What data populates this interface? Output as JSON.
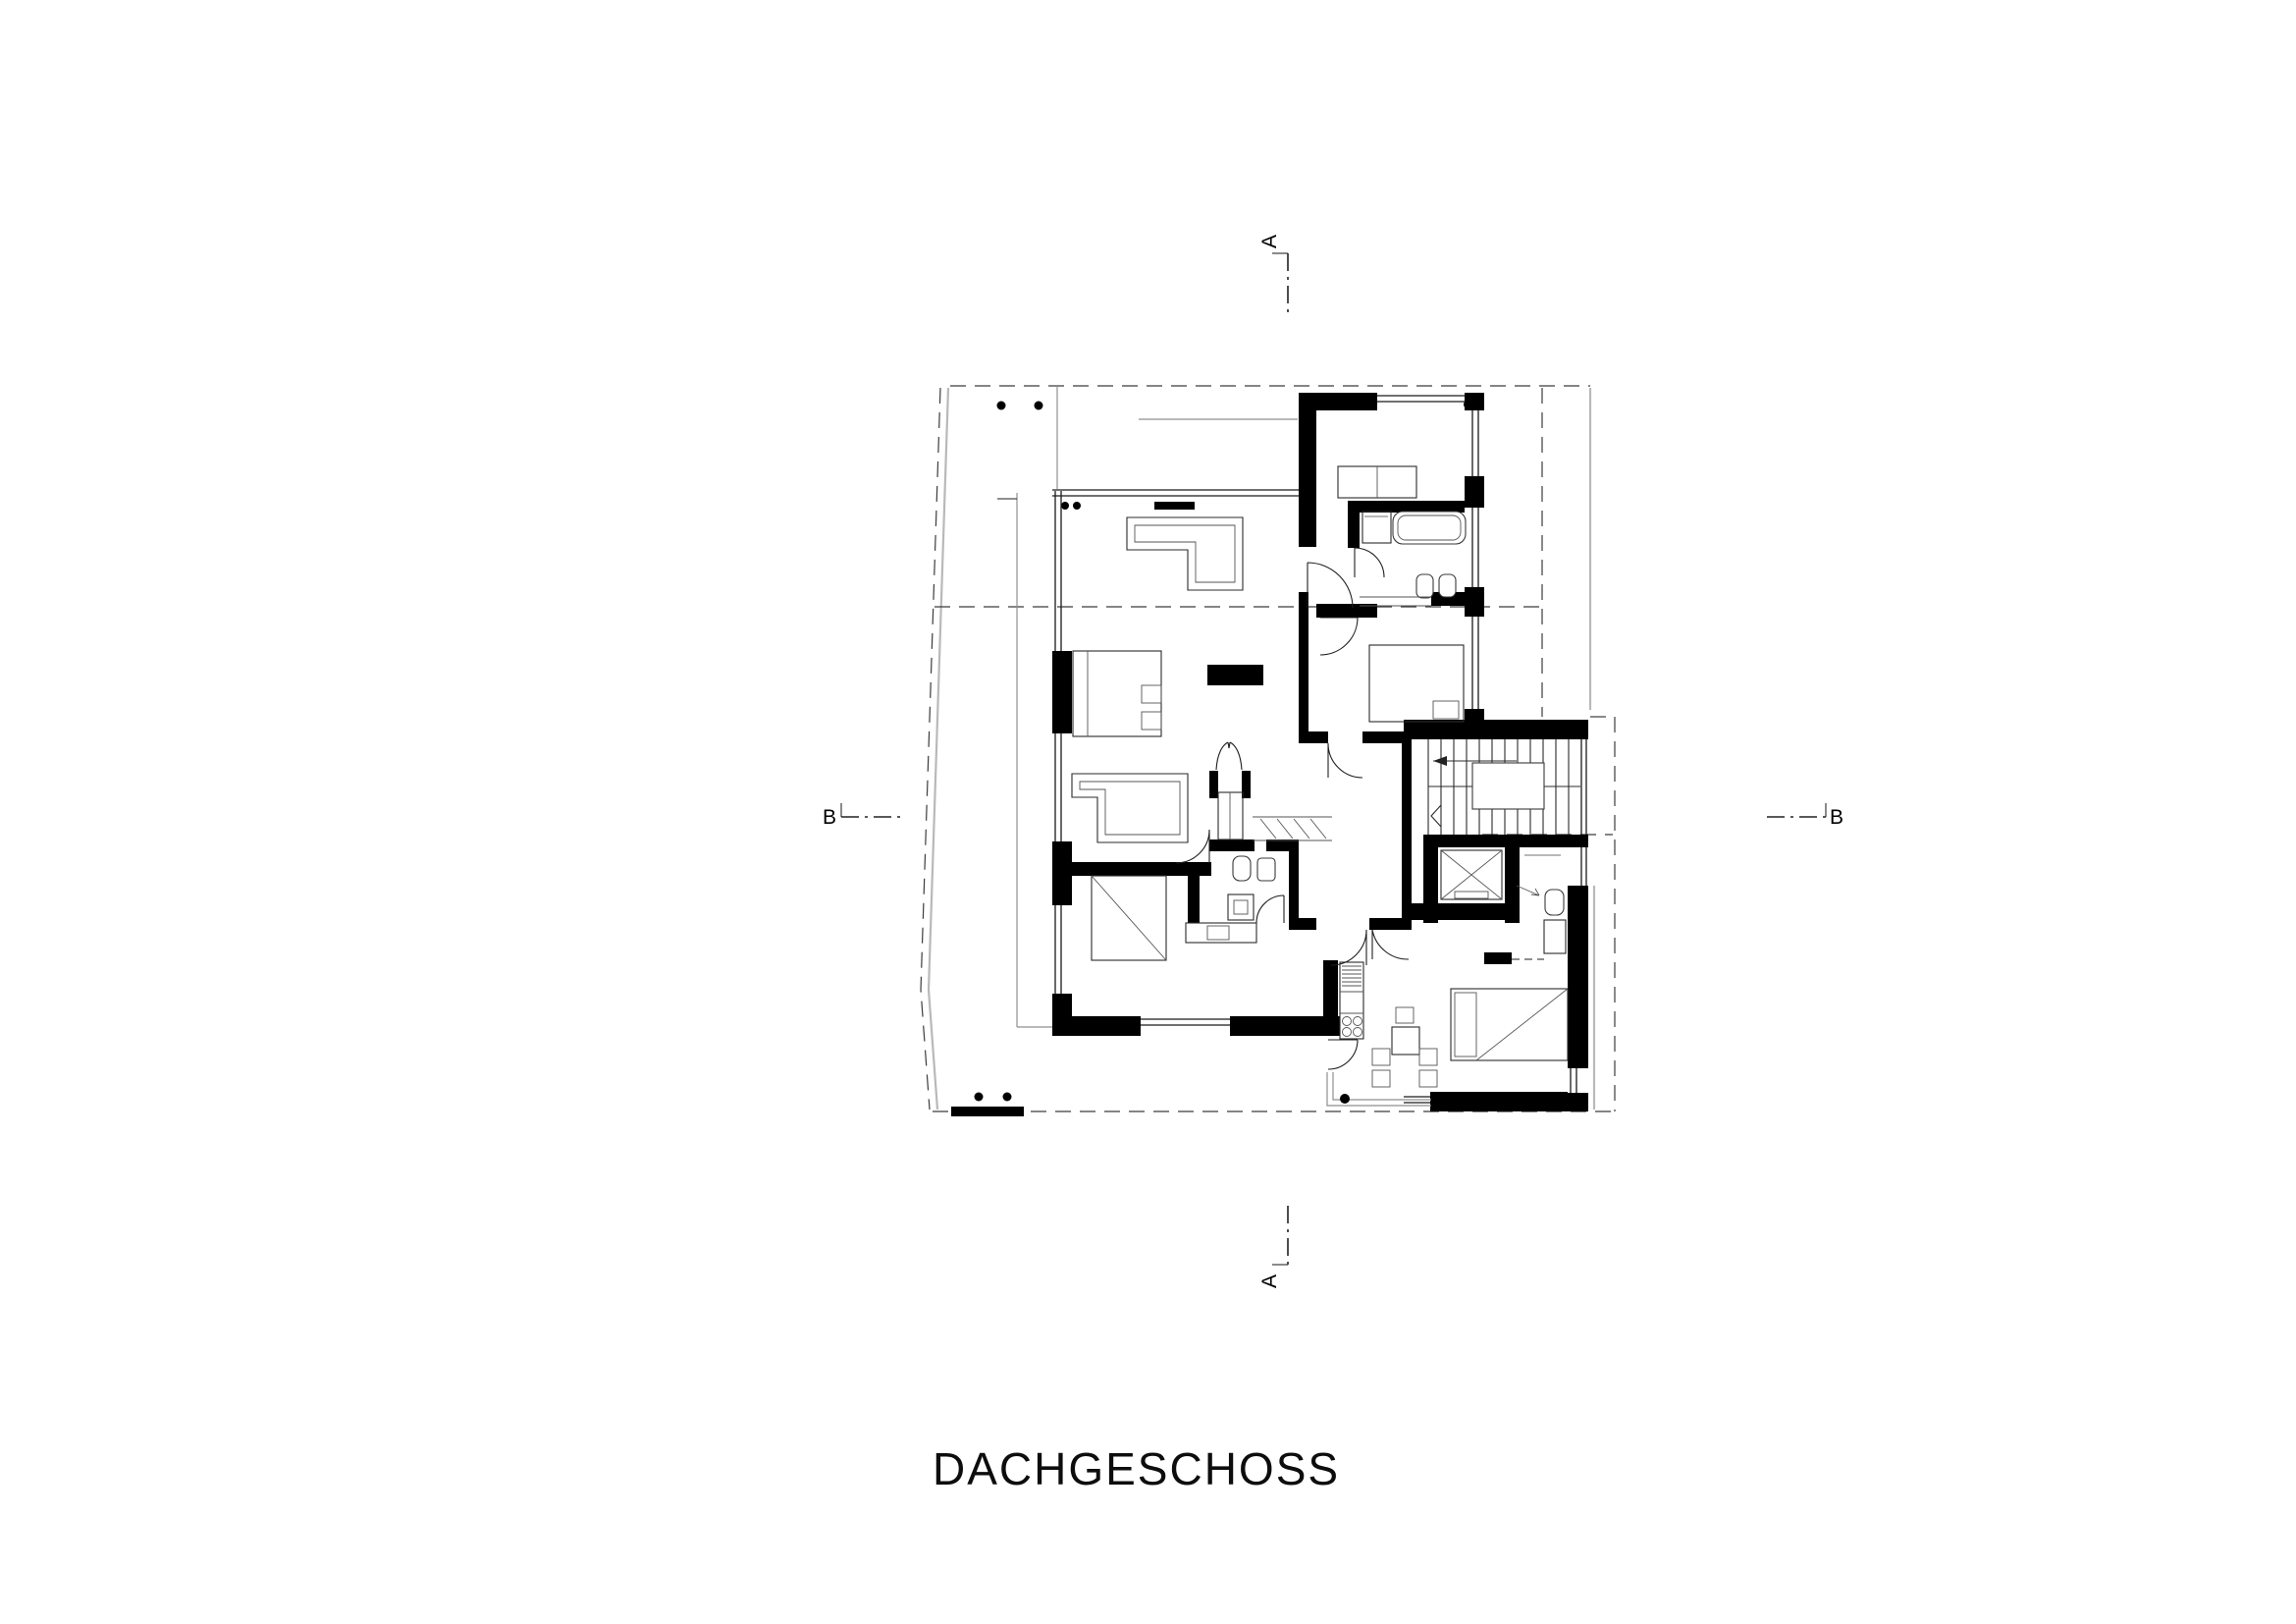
{
  "title": "DACHGESCHOSS",
  "section_markers": {
    "a_top": "A",
    "a_bottom": "A",
    "b_left": "B",
    "b_right": "B"
  },
  "colors": {
    "background": "#ffffff",
    "wall": "#000000",
    "line": "#2b2b2b",
    "context_gray": "#b9b9b9",
    "dashed": "#3c3c3c"
  },
  "drawing": {
    "type": "architectural-floor-plan",
    "floor": "Dachgeschoss (attic floor)",
    "fixtures": [
      "l-sofa",
      "fireplace",
      "master-bed",
      "guest-furniture",
      "single-bed",
      "double-bed",
      "studio-bed",
      "bathtub",
      "vanity",
      "wc",
      "bidet",
      "washbasin",
      "shower",
      "kitchenette",
      "dining-table-chairs",
      "u-stairs",
      "elevator",
      "coat-closet",
      "roof-terrace"
    ]
  }
}
